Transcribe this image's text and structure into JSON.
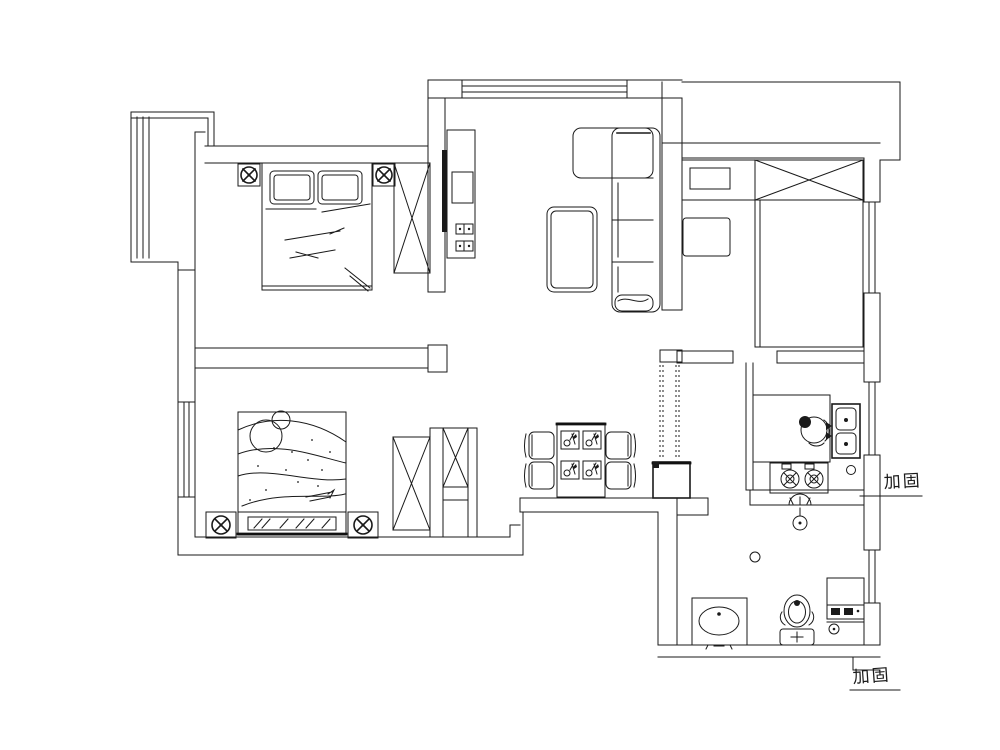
{
  "drawing": {
    "type": "apartment-floor-plan",
    "background": "#ffffff",
    "line_color": "#1a1a1a",
    "annotations": [
      {
        "text": "加固"
      },
      {
        "text": "加固"
      }
    ]
  }
}
